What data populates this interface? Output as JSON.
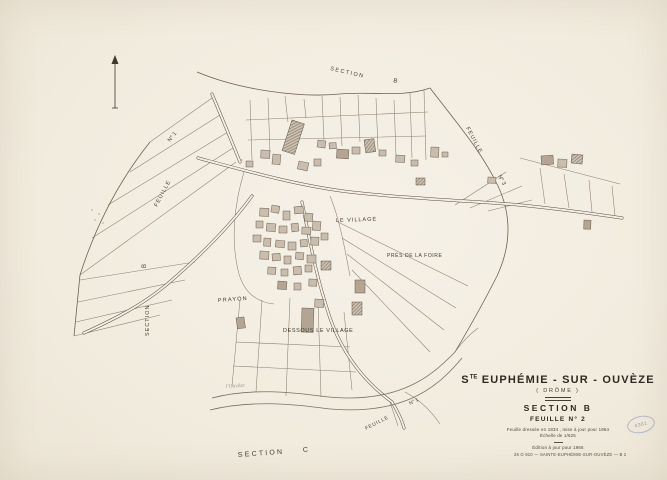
{
  "document_type": "cadastral map sheet",
  "colors": {
    "paper": "#f3eee3",
    "ink": "#453c33",
    "parcel_line": "#8b7e6f",
    "building_fill": "#c9bdae",
    "river_line": "#7a6f63",
    "stamp_blue": "#7d8fb2"
  },
  "edge_labels": {
    "top_section_word": "SECTION",
    "top_section_letter": "B",
    "right_feuille_word": "FEUILLE",
    "right_feuille_number": "N° 3",
    "left_feuille_word": "FEUILLE",
    "left_feuille_number": "N° 1",
    "left_section_word": "SECTION",
    "left_section_letter": "B",
    "bottom_section_word": "SECTION",
    "bottom_section_letter": "C",
    "bottom_right_feuille_word": "FEUILLE",
    "bottom_right_feuille_number": "N° 1"
  },
  "place_labels": {
    "le_village": "LE  VILLAGE",
    "pres_de_la_foire": "PRÈS  DE  LA  FOIRE",
    "prayon": "PRAYON",
    "dessous_le_village": "DESSOUS  LE  VILLAGE",
    "river_name": "l'Ouvèze"
  },
  "title_block": {
    "commune_prefix": "S",
    "commune_superscript": "TE",
    "commune_name": " EUPHÉMIE - SUR - OUVÈZE",
    "department": "( DRÔME )",
    "section_label": "SECTION  B",
    "sheet_label": "FEUILLE  N° 2",
    "note_revision": "Feuille dressée en 1834 , mise à jour pour 1964",
    "note_scale": "Échelle de 1/625",
    "note_edition": "Édition à jour pour 1966",
    "reference_line": "26 O 910 — SAINTE-EUPHÉMIE-SUR-OUVÈZE — B 2"
  },
  "stamp": {
    "number": "4361"
  }
}
